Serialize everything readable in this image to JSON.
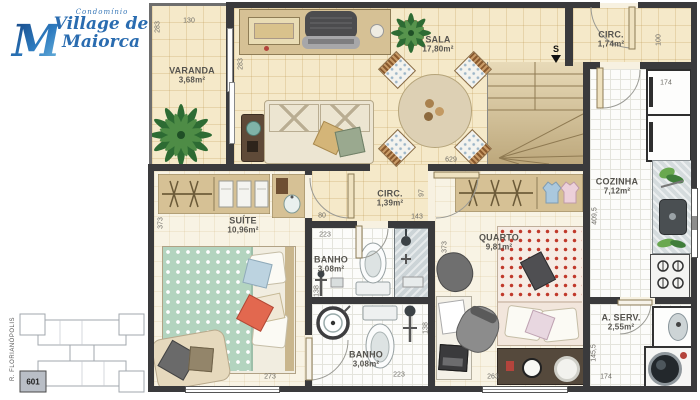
{
  "logo": {
    "prefix": "Condomínio",
    "monogram": "M",
    "name_line1": "Village de",
    "name_line2": "Maiorca"
  },
  "keyplan": {
    "unit": "601",
    "street": "R. FLORIANÓPOLIS"
  },
  "stairs": {
    "marker": "S"
  },
  "rooms": {
    "varanda": {
      "name": "VARANDA",
      "area": "3,68m²"
    },
    "sala": {
      "name": "SALA",
      "area": "17,80m²"
    },
    "circ_upper": {
      "name": "CIRC.",
      "area": "1,74m²"
    },
    "cozinha": {
      "name": "COZINHA",
      "area": "7,12m²"
    },
    "area_servico": {
      "name": "A. SERV.",
      "area": "2,55m²"
    },
    "suite": {
      "name": "SUÍTE",
      "area": "10,96m²"
    },
    "banho_social": {
      "name": "BANHO",
      "area": "3,08m²"
    },
    "banho_suite": {
      "name": "BANHO",
      "area": "3,08m²"
    },
    "circ_lower": {
      "name": "CIRC.",
      "area": "1,39m²"
    },
    "quarto": {
      "name": "QUARTO",
      "area": "9,81m²"
    }
  },
  "dims": {
    "varanda_height": "283",
    "varanda_width": "130",
    "sala_west_wall": "283",
    "sala_width": "629",
    "circ_upper_depth": "100",
    "fridge_width": "174",
    "cozinha_height": "409,5",
    "aserv_height": "145,5",
    "aserv_width": "174",
    "suite_height": "373",
    "suite_width": "273",
    "suite_nook": "80",
    "banho_social_width": "223",
    "banho_social_height": "138",
    "circ_lower_height": "97",
    "circ_lower_width": "143",
    "quarto_height": "373",
    "quarto_width": "263",
    "banho_suite_height": "138",
    "banho_suite_width": "223"
  },
  "colors": {
    "logo_blue": "#2a6cb0",
    "wall": "#3a3a3c",
    "floor_cream": "#f5e9c9",
    "floor_pale": "#f8f3e4",
    "bed_green": "#b3d4bf",
    "bed_red_dots": "#c0392b"
  }
}
